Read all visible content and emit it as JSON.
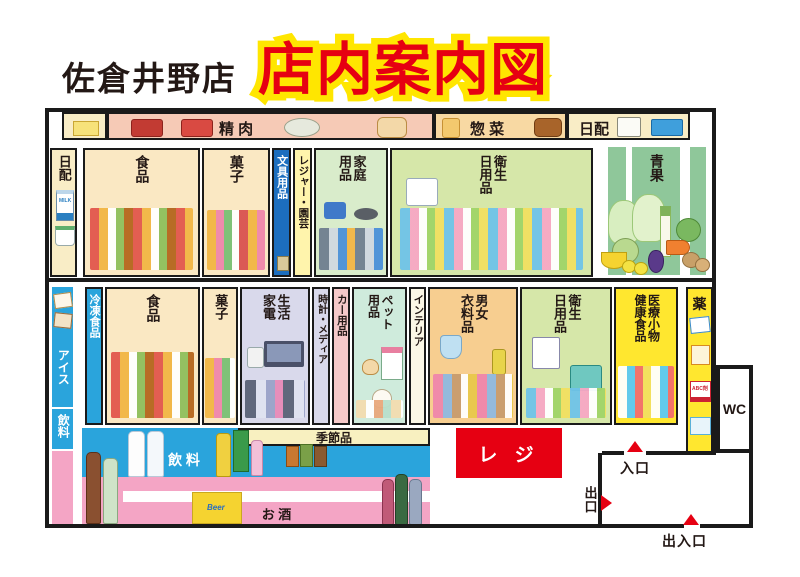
{
  "header": {
    "store_name": "佐倉井野店",
    "title": "店内案内図"
  },
  "top_aisle": {
    "meat": "精 肉",
    "deli": "惣 菜",
    "daily": "日配"
  },
  "left_aisle": {
    "daily": "日配",
    "ice": "アイス",
    "drinks": "飲料"
  },
  "row1": {
    "food": "食品",
    "sweets": "菓子",
    "stationery": "文具用品",
    "leisure": "レジャー・園芸",
    "household": "家庭\n用品",
    "hygiene": "衛生\n日用品",
    "produce": "青果"
  },
  "row2": {
    "frozen": "冷凍食品",
    "food": "食品",
    "sweets": "菓子",
    "appliances": "生活\n家電",
    "media": "時計・メディア",
    "car": "カー用品",
    "pets": "ペット\n用品",
    "interior": "インテリア",
    "clothing": "男女\n衣料品",
    "hygiene": "衛生\n日用品",
    "health": "医療小物\n健康食品",
    "drugs": "薬"
  },
  "bottom_aisle": {
    "drinks": "飲 料",
    "seasonal": "季節品",
    "alcohol": "お 酒"
  },
  "checkout": {
    "label": "レ ジ"
  },
  "markers": {
    "entrance": "入口",
    "exit": "出口",
    "main_gate": "出入口",
    "wc": "WC"
  },
  "artwork_text": {
    "milk": "MILK",
    "beer": "Beer",
    "abc": "ABC剤"
  },
  "colors": {
    "wall": "#1a1a1a",
    "accent_red": "#e60012",
    "title_yellow": "#ffe600",
    "cream": "#f9edc6",
    "meat_pink": "#f6cab6",
    "deli_orange": "#f8d9a3",
    "blue_strip": "#2aa4dc",
    "stationery_blue": "#1c6ebf",
    "leisure_yellow": "#fff4ac",
    "household_green": "#d9eccb",
    "hygiene_green": "#d6e7a9",
    "produce_green": "#8fc79a",
    "appliance_lavender": "#d9d9eb",
    "car_pink": "#f6c9c9",
    "pet_teal": "#cfebdc",
    "clothing_orange": "#f7ce90",
    "medical_yellow": "#ffe72f",
    "shelf_pink": "#f4a5c5"
  }
}
